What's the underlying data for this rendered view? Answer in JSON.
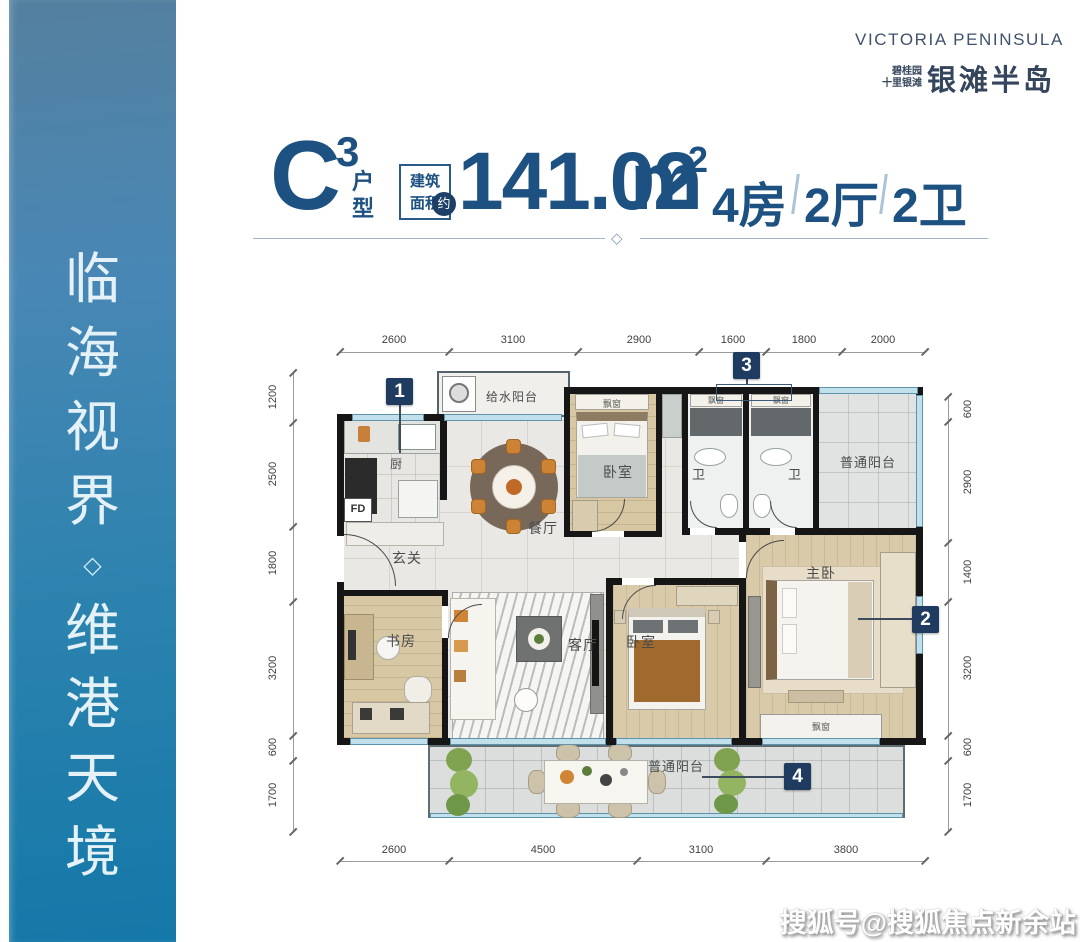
{
  "sidebar": {
    "chars": [
      "临",
      "海",
      "视",
      "界",
      "◇",
      "维",
      "港",
      "天",
      "境"
    ]
  },
  "logo": {
    "en": "VICTORIA PENINSULA",
    "cn_line1": "碧桂园",
    "cn_line2": "十里银滩",
    "cn_main": "银滩半岛"
  },
  "title": {
    "unit_letter": "C",
    "unit_sup": "3",
    "unit_char1": "户",
    "unit_char2": "型",
    "area_label_line1": "建筑",
    "area_label_line2": "面积",
    "area_label_badge": "约",
    "area_value": "141.02",
    "area_unit": "m",
    "area_unit_sup": "2",
    "spec1": "4房",
    "spec2": "2厅",
    "spec3": "2卫",
    "divider_glyph": "◇"
  },
  "dimensions": {
    "top": [
      "2600",
      "3100",
      "2900",
      "1600",
      "1800",
      "2000"
    ],
    "bottom": [
      "2600",
      "4500",
      "3100",
      "3800"
    ],
    "left": [
      "1200",
      "2500",
      "1800",
      "3200",
      "600",
      "1700"
    ],
    "right": [
      "600",
      "2900",
      "1400",
      "3200",
      "600",
      "1700"
    ]
  },
  "markers": {
    "m1": "1",
    "m2": "2",
    "m3": "3",
    "m4": "4"
  },
  "rooms": {
    "water_balcony": "给水阳台",
    "kitchen": "厨",
    "kitchen_fd": "FD",
    "dining": "餐厅",
    "foyer": "玄关",
    "bedroom_top": "卧室",
    "bath_a": "卫",
    "bath_b": "卫",
    "balcony_right": "普通阳台",
    "study": "书房",
    "living": "客厅",
    "bedroom_mid": "卧室",
    "master": "主卧",
    "balcony_bottom": "普通阳台",
    "bay_window": "飘窗"
  },
  "watermark": "搜狐号@搜狐焦点新余站",
  "colors": {
    "accent_navy": "#1d5181",
    "marker_bg": "#1f3c60",
    "sidebar_top": "#54809f",
    "sidebar_bottom": "#1478a8",
    "window_teal": "#c2e0ec"
  }
}
